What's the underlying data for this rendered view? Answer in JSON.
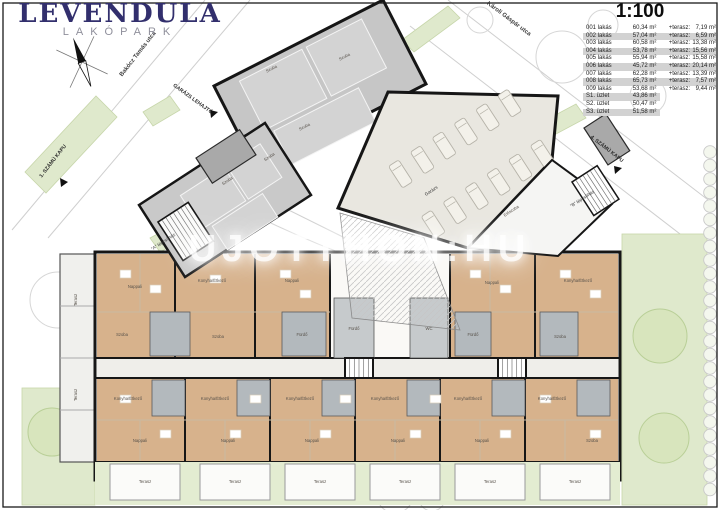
{
  "logo": {
    "title": "LEVENDULA",
    "subtitle": "LAKÓPARK"
  },
  "scale_label": "1:100",
  "watermark": "UJOTTHON:HU",
  "area_table": {
    "rows": [
      {
        "unit": "001 lakás",
        "area": "60,34 m²",
        "terrace_label": "+terasz:",
        "terrace": "7,19 m²"
      },
      {
        "unit": "002 lakás",
        "area": "57,04 m²",
        "terrace_label": "+terasz:",
        "terrace": "6,59 m²"
      },
      {
        "unit": "003 lakás",
        "area": "60,58 m²",
        "terrace_label": "+terasz:",
        "terrace": "13,38 m²"
      },
      {
        "unit": "004 lakás",
        "area": "53,78 m²",
        "terrace_label": "+terasz:",
        "terrace": "15,56 m²"
      },
      {
        "unit": "005 lakás",
        "area": "55,94 m²",
        "terrace_label": "+terasz:",
        "terrace": "15,58 m²"
      },
      {
        "unit": "006 lakás",
        "area": "45,72 m²",
        "terrace_label": "+terasz:",
        "terrace": "20,14 m²"
      },
      {
        "unit": "007 lakás",
        "area": "62,28 m²",
        "terrace_label": "+terasz:",
        "terrace": "13,39 m²"
      },
      {
        "unit": "008 lakás",
        "area": "65,73 m²",
        "terrace_label": "+terasz:",
        "terrace": "7,57 m²"
      },
      {
        "unit": "009 lakás",
        "area": "53,68 m²",
        "terrace_label": "+terasz:",
        "terrace": "9,44 m²"
      },
      {
        "unit": "S1. üzlet",
        "area": "43,86 m²",
        "terrace_label": "",
        "terrace": ""
      },
      {
        "unit": "S2. üzlet",
        "area": "50,47 m²",
        "terrace_label": "",
        "terrace": ""
      },
      {
        "unit": "S3. üzlet",
        "area": "51,58 m²",
        "terrace_label": "",
        "terrace": ""
      }
    ]
  },
  "site_labels": {
    "street_left": "Bakócz Tamás utca",
    "street_top": "Károli Gáspár utca",
    "gate1": "1. SZÁMÚ KAPU",
    "gate4": "4. SZÁMÚ KAPU",
    "garage_ramp": "GARÁZS LEHAJTÓ",
    "stair_a": "\"A\" lépcsőház",
    "stair_b": "\"B\" lépcsőház",
    "garage": "Garázs"
  },
  "room_labels": [
    {
      "t": "Szoba",
      "x": 272,
      "y": 70,
      "r": -27
    },
    {
      "t": "Szoba",
      "x": 345,
      "y": 58,
      "r": -27
    },
    {
      "t": "Szoba",
      "x": 305,
      "y": 128,
      "r": -27
    },
    {
      "t": "Szoba",
      "x": 228,
      "y": 182,
      "r": -33
    },
    {
      "t": "Szoba",
      "x": 270,
      "y": 158,
      "r": -33
    },
    {
      "t": "Előszoba",
      "x": 512,
      "y": 212,
      "r": -33
    },
    {
      "t": "Nappali",
      "x": 135,
      "y": 288
    },
    {
      "t": "Szoba",
      "x": 122,
      "y": 336
    },
    {
      "t": "Konyha/Étkező",
      "x": 212,
      "y": 282
    },
    {
      "t": "Szoba",
      "x": 218,
      "y": 338
    },
    {
      "t": "Nappali",
      "x": 292,
      "y": 282
    },
    {
      "t": "Fürdő",
      "x": 302,
      "y": 336
    },
    {
      "t": "Nappali",
      "x": 492,
      "y": 284
    },
    {
      "t": "Konyha/Étkező",
      "x": 578,
      "y": 282
    },
    {
      "t": "Fürdő",
      "x": 473,
      "y": 336
    },
    {
      "t": "Szoba",
      "x": 560,
      "y": 338
    },
    {
      "t": "Fürdő",
      "x": 354,
      "y": 330
    },
    {
      "t": "WC",
      "x": 429,
      "y": 330
    },
    {
      "t": "Konyha/Étkező",
      "x": 128,
      "y": 400
    },
    {
      "t": "Nappali",
      "x": 140,
      "y": 442
    },
    {
      "t": "Konyha/Étkező",
      "x": 215,
      "y": 400
    },
    {
      "t": "Nappali",
      "x": 228,
      "y": 442
    },
    {
      "t": "Konyha/Étkező",
      "x": 300,
      "y": 400
    },
    {
      "t": "Nappali",
      "x": 312,
      "y": 442
    },
    {
      "t": "Konyha/Étkező",
      "x": 385,
      "y": 400
    },
    {
      "t": "Nappali",
      "x": 398,
      "y": 442
    },
    {
      "t": "Konyha/Étkező",
      "x": 468,
      "y": 400
    },
    {
      "t": "Nappali",
      "x": 482,
      "y": 442
    },
    {
      "t": "Konyha/Étkező",
      "x": 552,
      "y": 400
    },
    {
      "t": "Szoba",
      "x": 592,
      "y": 442
    },
    {
      "t": "Terasz",
      "x": 145,
      "y": 483
    },
    {
      "t": "Terasz",
      "x": 235,
      "y": 483
    },
    {
      "t": "Terasz",
      "x": 320,
      "y": 483
    },
    {
      "t": "Terasz",
      "x": 405,
      "y": 483
    },
    {
      "t": "Terasz",
      "x": 490,
      "y": 483
    },
    {
      "t": "Terasz",
      "x": 575,
      "y": 483
    },
    {
      "t": "Terasz",
      "x": 77,
      "y": 300,
      "r": -90
    },
    {
      "t": "Terasz",
      "x": 77,
      "y": 395,
      "r": -90
    }
  ],
  "colors": {
    "wall": "#161616",
    "room_tan": "#d7b28c",
    "room_gray": "#b3b9bd",
    "terrace_green": "#e3ecd1",
    "lawn_green": "#dfe9cc",
    "building_gray": "#c6c6c6",
    "paving": "#e9e7e0",
    "logo_navy": "#322f6d",
    "logo_gray": "#8f8f9b"
  }
}
